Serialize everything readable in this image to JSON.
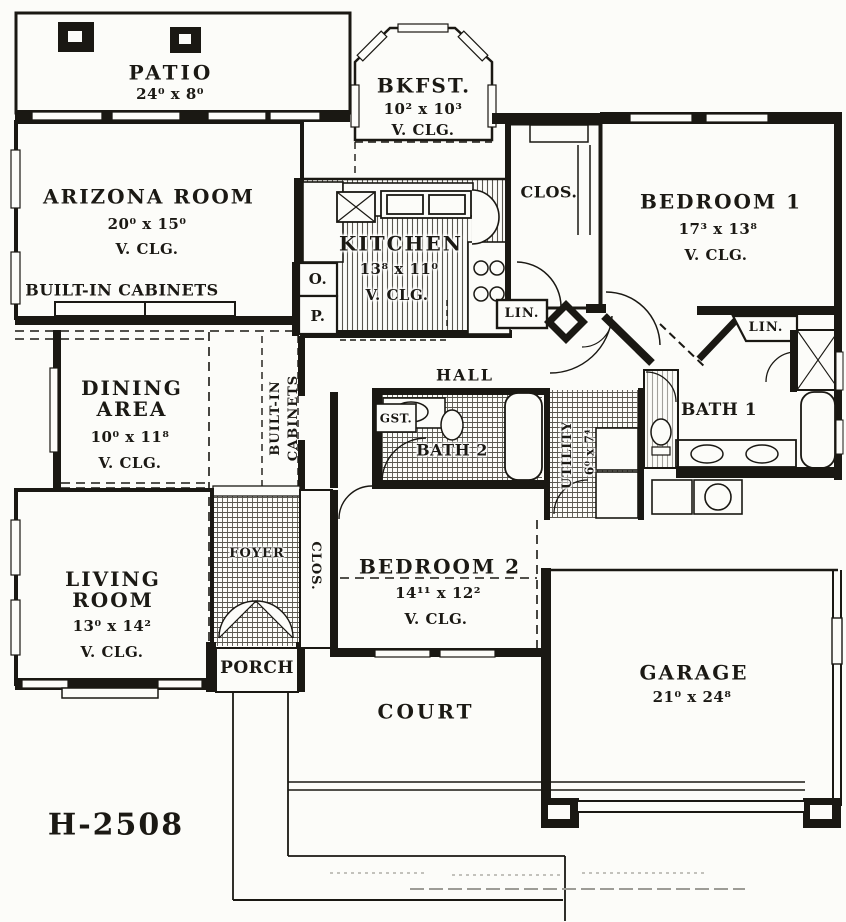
{
  "plan_number": "H-2508",
  "rooms": {
    "patio": {
      "name": "PATIO",
      "dims": "24⁰ x 8⁰"
    },
    "bkfst": {
      "name": "BKFST.",
      "dims": "10² x 10³",
      "ceiling": "V. CLG."
    },
    "arizona": {
      "name": "ARIZONA ROOM",
      "dims": "20⁰ x 15⁰",
      "ceiling": "V. CLG."
    },
    "kitchen": {
      "name": "KITCHEN",
      "dims": "13⁸ x 11⁰",
      "ceiling": "V. CLG."
    },
    "closet1": {
      "name": "CLOS."
    },
    "bedroom1": {
      "name": "BEDROOM 1",
      "dims": "17³ x 13⁸",
      "ceiling": "V. CLG."
    },
    "dining": {
      "name": "DINING AREA",
      "dims": "10⁰ x 11⁸",
      "ceiling": "V. CLG."
    },
    "living": {
      "name": "LIVING ROOM",
      "dims": "13⁰ x 14²",
      "ceiling": "V. CLG."
    },
    "bedroom2": {
      "name": "BEDROOM 2",
      "dims": "14¹¹ x 12²",
      "ceiling": "V. CLG."
    },
    "bath1": {
      "name": "BATH 1"
    },
    "bath2": {
      "name": "BATH 2"
    },
    "utility": {
      "name": "UTILITY",
      "dims": "6⁰ x 7⁴"
    },
    "foyer": {
      "name": "FOYER"
    },
    "closet2": {
      "name": "CLOS."
    },
    "porch": {
      "name": "PORCH"
    },
    "court": {
      "name": "COURT"
    },
    "garage": {
      "name": "GARAGE",
      "dims": "21⁰ x 24⁸"
    },
    "hall": {
      "name": "HALL"
    }
  },
  "labels": {
    "built_in_cabinets": "BUILT-IN CABINETS",
    "built_in": "BUILT-IN",
    "cabinets": "CABINETS",
    "oven": "O.",
    "pantry": "P.",
    "linen1": "LIN.",
    "linen2": "LIN.",
    "guest_closet": "GST."
  },
  "ink_color": "#1a1813",
  "hatch_color": "#5a5750"
}
